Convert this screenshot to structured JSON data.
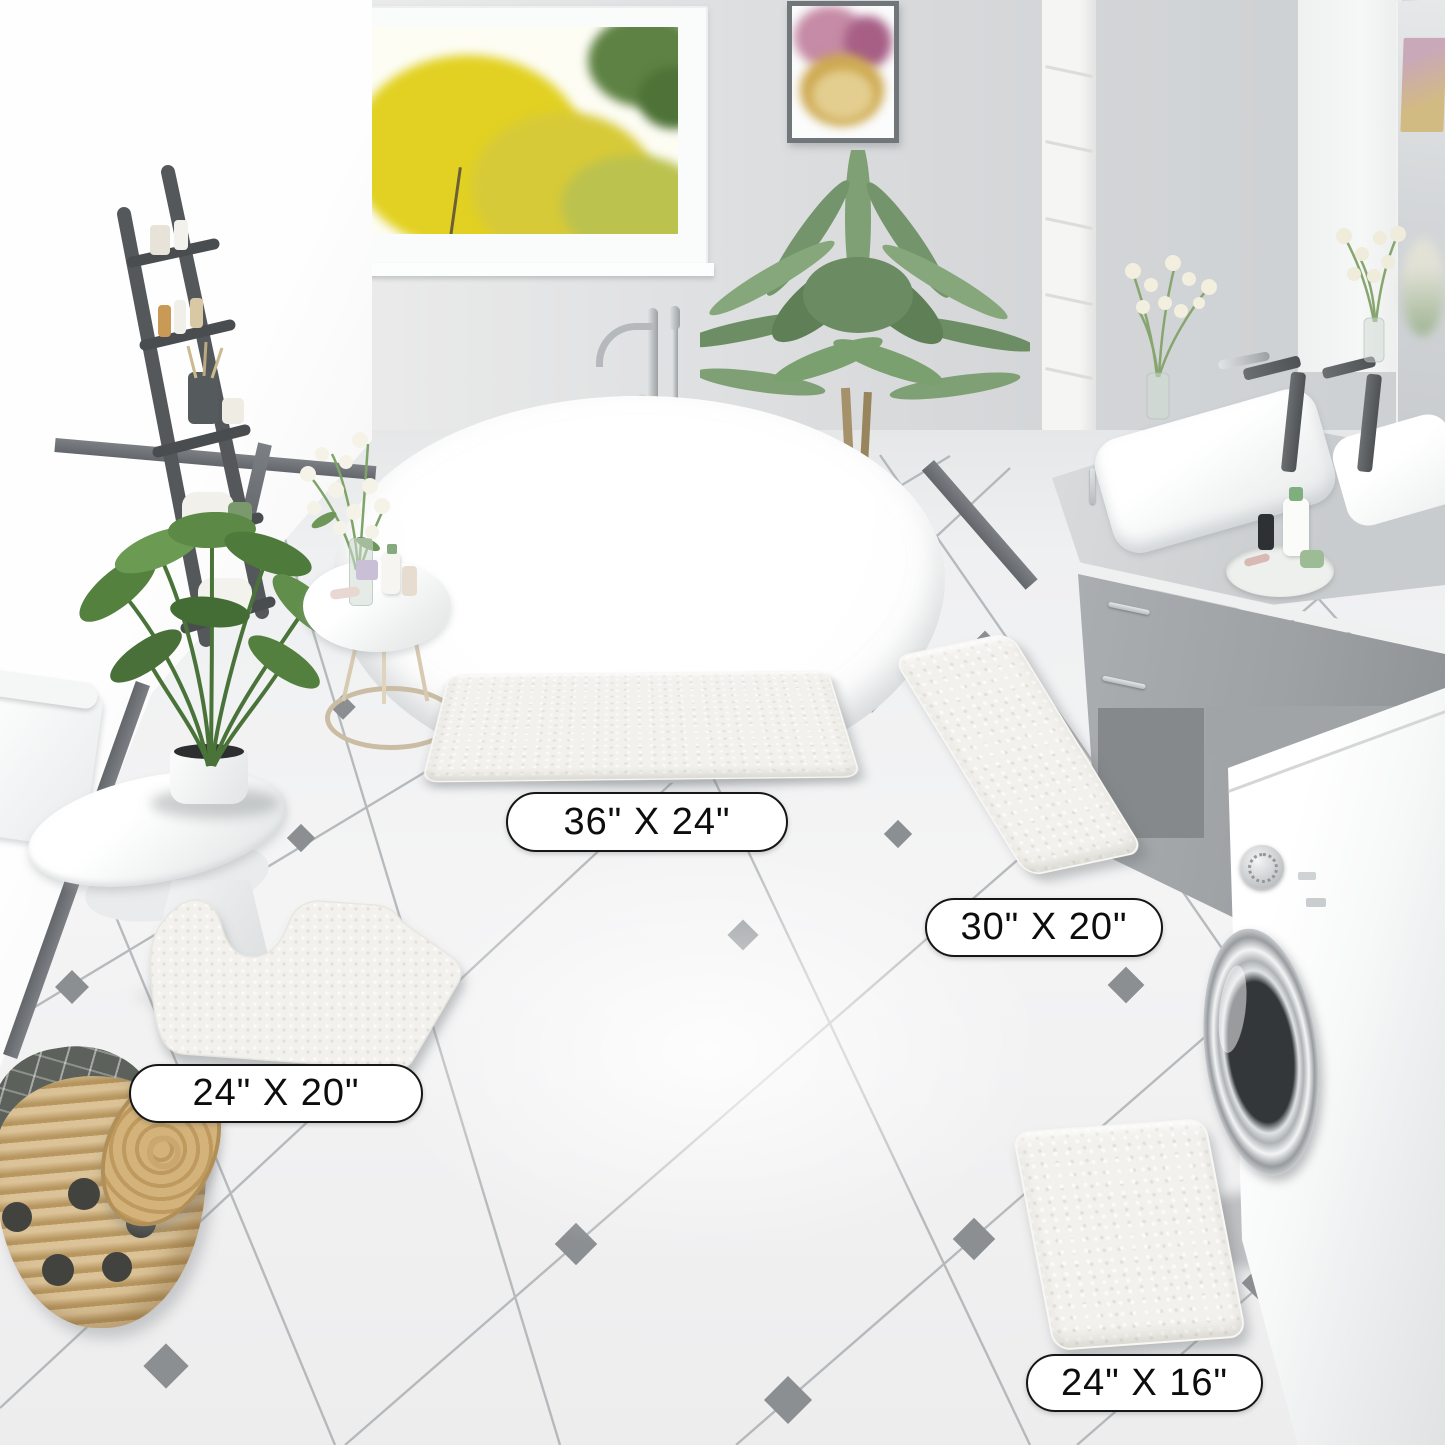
{
  "labels": {
    "mat_large": "36\" X 24\"",
    "mat_medium": "30\" X 20\"",
    "mat_contour": "24\" X 20\"",
    "mat_small": "24\" X 16\""
  },
  "palette": {
    "wall_left": "#fbfbfb",
    "wall_back": "#d3d5d7",
    "accent_dark_gray": "#6d7175",
    "floor": "#f2f3f4",
    "tile_line": "#a7abae",
    "tile_diamond": "#8b8f92",
    "mat": "#f2f1ed",
    "vanity_gray": "#a9adb0",
    "basket_tan": "#c8a76f",
    "plant_green": "#5c8a46",
    "window_foliage_yellow": "#e0d024",
    "label_border": "#161616",
    "label_background": "#ffffff"
  }
}
